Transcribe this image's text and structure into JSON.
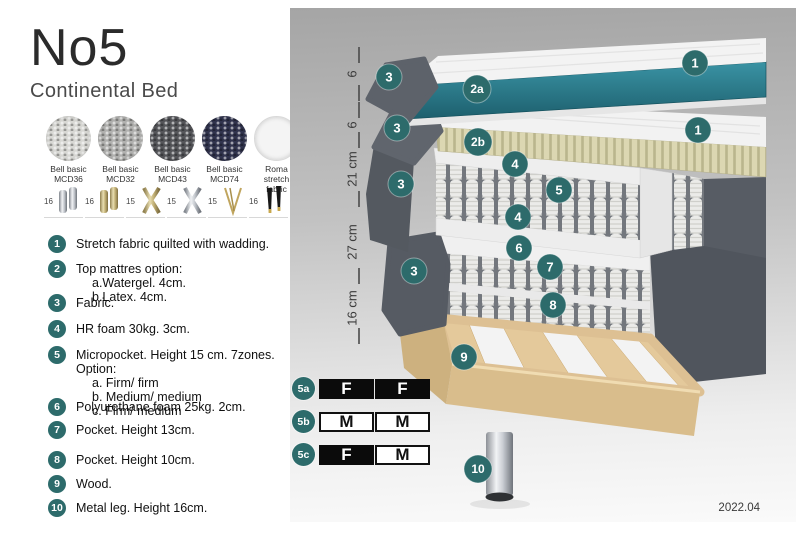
{
  "header": {
    "title": "No5",
    "subtitle": "Continental Bed"
  },
  "fabrics": [
    {
      "line1": "Bell basic",
      "line2": "MCD36",
      "color": "#d8d8d4"
    },
    {
      "line1": "Bell basic",
      "line2": "MCD32",
      "color": "#b1b1af"
    },
    {
      "line1": "Bell basic",
      "line2": "MCD43",
      "color": "#55565a"
    },
    {
      "line1": "Bell basic",
      "line2": "MCD74",
      "color": "#31344e"
    },
    {
      "line1": "Roma",
      "line2": "stretch fabric",
      "color": "#f4f4f4"
    }
  ],
  "legs_options": [
    {
      "label": "16",
      "style": "cylinder-silver"
    },
    {
      "label": "16",
      "style": "cylinder-brass"
    },
    {
      "label": "15",
      "style": "cross-gold"
    },
    {
      "label": "15",
      "style": "cross-silver"
    },
    {
      "label": "15",
      "style": "hairpin"
    },
    {
      "label": "16",
      "style": "black-gold-tip"
    }
  ],
  "features": [
    {
      "num": "1",
      "text": "Stretch fabric quilted with wadding."
    },
    {
      "num": "2",
      "text": "Top mattres option:",
      "subs": [
        "a.Watergel. 4cm.",
        "b.Latex. 4cm."
      ]
    },
    {
      "num": "3",
      "text": "Fabric."
    },
    {
      "num": "4",
      "text": "HR foam 30kg. 3cm."
    },
    {
      "num": "5",
      "text": "Micropocket. Height 15 cm. 7zones. Option:",
      "subs": [
        "a. Firm/ firm",
        "b. Medium/ medium",
        "c. Firm/ medium"
      ]
    },
    {
      "num": "6",
      "text": "Polyurethane foam 25kg. 2cm."
    },
    {
      "num": "7",
      "text": "Pocket. Height 13cm."
    },
    {
      "num": "8",
      "text": "Pocket. Height 10cm."
    },
    {
      "num": "9",
      "text": "Wood."
    },
    {
      "num": "10",
      "text": "Metal leg. Height 16cm."
    }
  ],
  "diagram": {
    "measurements": [
      "6",
      "6",
      "21 cm",
      "27 cm",
      "16 cm"
    ],
    "callouts": [
      "1",
      "2a",
      "3",
      "1",
      "2b",
      "3",
      "4",
      "5",
      "3",
      "4",
      "6",
      "7",
      "3",
      "8",
      "9",
      "10"
    ],
    "firmness": [
      {
        "label": "5a",
        "cells": [
          {
            "text": "F",
            "variant": "dark"
          },
          {
            "text": "F",
            "variant": "dark"
          }
        ]
      },
      {
        "label": "5b",
        "cells": [
          {
            "text": "M",
            "variant": "light"
          },
          {
            "text": "M",
            "variant": "light"
          }
        ]
      },
      {
        "label": "5c",
        "cells": [
          {
            "text": "F",
            "variant": "dark"
          },
          {
            "text": "M",
            "variant": "light"
          }
        ]
      }
    ],
    "version": "2022.04",
    "colors": {
      "accent_teal": "#2d6b6b",
      "mattress_teal": "#2a7e8f",
      "fabric_dark_gray": "#565b63",
      "latex_beige": "#d9d4b0",
      "wood": "#e2c99b"
    }
  }
}
